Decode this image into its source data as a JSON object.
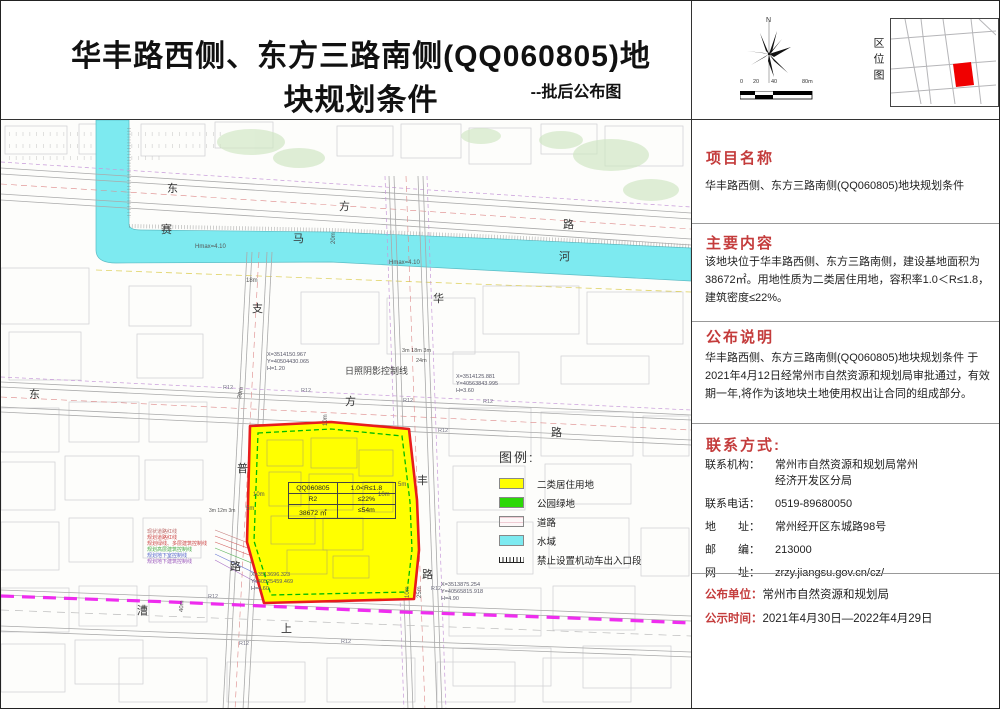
{
  "header": {
    "title": "华丰路西侧、东方三路南侧(QQ060805)地块规划条件",
    "subtitle": "--批后公布图"
  },
  "topright": {
    "north_label": "N",
    "scale_labels": [
      "0",
      "20",
      "40",
      "80m"
    ],
    "location_map_label": "区位图",
    "location_accent": "#f00000"
  },
  "sidebar": {
    "sections": [
      {
        "heading": "项目名称",
        "body": "华丰路西侧、东方三路南侧(QQ060805)地块规划条件"
      },
      {
        "heading": "主要内容",
        "body": "该地块位于华丰路西侧、东方三路南侧，建设基地面积为38672㎡。用地性质为二类居住用地，容积率1.0＜R≤1.8，建筑密度≤22%。"
      },
      {
        "heading": "公布说明",
        "body": "华丰路西侧、东方三路南侧(QQ060805)地块规划条件 于2021年4月12日经常州市自然资源和规划局审批通过，有效期一年,将作为该地块土地使用权出让合同的组成部分。"
      }
    ],
    "contact": {
      "heading": "联系方式:",
      "rows": [
        {
          "label": "联系机构：",
          "value": "常州市自然资源和规划局常州\n经济开发区分局"
        },
        {
          "label": "联系电话：",
          "value": "0519-89680050"
        },
        {
          "label": "地　　址：",
          "value": "常州经开区东城路98号"
        },
        {
          "label": "邮　　编：",
          "value": "213000"
        },
        {
          "label": "网　　址：",
          "value": "zrzy.jiangsu.gov.cn/cz/"
        }
      ]
    },
    "footer": [
      {
        "label": "公布单位：",
        "value": "常州市自然资源和规划局"
      },
      {
        "label": "公示时间：",
        "value": "2021年4月30日—2022年4月29日"
      }
    ]
  },
  "map": {
    "colors": {
      "water": "#7deaf0",
      "parcel_fill": "#ffff00",
      "parcel_border": "#e81c1c",
      "green_control_line": "#00bb00",
      "boundary_magenta": "#ee22ee",
      "heading_red": "#c43c3c"
    },
    "legend": {
      "title": "图例:",
      "items": [
        {
          "type": "residential",
          "label": "二类居住用地",
          "color": "#ffff00"
        },
        {
          "type": "park",
          "label": "公园绿地",
          "color": "#2cd806"
        },
        {
          "type": "road",
          "label": "道路",
          "color": "#fdf7f8"
        },
        {
          "type": "water",
          "label": "水域",
          "color": "#7deaf0"
        },
        {
          "type": "no-vehicle-access",
          "label": "禁止设置机动车出入口段",
          "color": "#222222"
        }
      ]
    },
    "parcel_table": {
      "rows": [
        [
          "QQ060805",
          "1.0<R≤1.8"
        ],
        [
          "R2",
          "≤22%"
        ],
        [
          "38672 ㎡",
          "≤54m"
        ]
      ]
    },
    "labels": [
      {
        "t": "东",
        "x": 166,
        "y": 62
      },
      {
        "t": "方",
        "x": 338,
        "y": 80
      },
      {
        "t": "路",
        "x": 562,
        "y": 98
      },
      {
        "t": "赛",
        "x": 160,
        "y": 103
      },
      {
        "t": "马",
        "x": 292,
        "y": 112
      },
      {
        "t": "河",
        "x": 558,
        "y": 130
      },
      {
        "t": "东",
        "x": 28,
        "y": 268
      },
      {
        "t": "方",
        "x": 344,
        "y": 275
      },
      {
        "t": "路",
        "x": 550,
        "y": 306
      },
      {
        "t": "华",
        "x": 432,
        "y": 172
      },
      {
        "t": "丰",
        "x": 416,
        "y": 354
      },
      {
        "t": "路",
        "x": 421,
        "y": 448
      },
      {
        "t": "支",
        "x": 251,
        "y": 182
      },
      {
        "t": "普",
        "x": 236,
        "y": 342
      },
      {
        "t": "路",
        "x": 229,
        "y": 440
      },
      {
        "t": "漕",
        "x": 136,
        "y": 484
      },
      {
        "t": "上",
        "x": 280,
        "y": 502
      },
      {
        "t": "18m",
        "x": 245,
        "y": 158,
        "s": 6,
        "c": "#555"
      },
      {
        "t": "Hmax=4.10",
        "x": 194,
        "y": 124,
        "s": 6,
        "c": "#555"
      },
      {
        "t": "Hmax=4.10",
        "x": 388,
        "y": 140,
        "s": 6,
        "c": "#555"
      },
      {
        "t": "日照阴影控制线",
        "x": 344,
        "y": 246,
        "s": 9,
        "c": "#444"
      },
      {
        "t": "3m 18m 3m",
        "x": 401,
        "y": 228,
        "s": 5.5,
        "c": "#555"
      },
      {
        "t": "24m",
        "x": 415,
        "y": 238,
        "s": 5.5,
        "c": "#555"
      },
      {
        "t": "3m 12m 3m",
        "x": 208,
        "y": 388,
        "s": 5,
        "c": "#555"
      },
      {
        "t": "10m",
        "x": 252,
        "y": 372,
        "s": 6,
        "c": "#555"
      },
      {
        "t": "5m",
        "x": 245,
        "y": 386,
        "s": 6,
        "c": "#555"
      },
      {
        "t": "10m",
        "x": 377,
        "y": 372,
        "s": 6,
        "c": "#555"
      },
      {
        "t": "5m",
        "x": 397,
        "y": 362,
        "s": 6,
        "c": "#555"
      },
      {
        "t": "R12",
        "x": 222,
        "y": 265,
        "s": 5.5,
        "c": "#778"
      },
      {
        "t": "R12",
        "x": 300,
        "y": 268,
        "s": 5.5,
        "c": "#778"
      },
      {
        "t": "R12",
        "x": 402,
        "y": 278,
        "s": 5.5,
        "c": "#778"
      },
      {
        "t": "R12",
        "x": 482,
        "y": 279,
        "s": 5.5,
        "c": "#778"
      },
      {
        "t": "R12",
        "x": 437,
        "y": 308,
        "s": 5.5,
        "c": "#778"
      },
      {
        "t": "R12",
        "x": 207,
        "y": 474,
        "s": 5.5,
        "c": "#778"
      },
      {
        "t": "R12",
        "x": 238,
        "y": 521,
        "s": 5.5,
        "c": "#778"
      },
      {
        "t": "R12",
        "x": 430,
        "y": 466,
        "s": 5.5,
        "c": "#778"
      },
      {
        "t": "R12",
        "x": 340,
        "y": 519,
        "s": 5.5,
        "c": "#778"
      },
      {
        "t": "X=3514150.967\nY=40504430.065\nH=1.20",
        "x": 266,
        "y": 232,
        "s": 5.5,
        "c": "#556"
      },
      {
        "t": "X=3514125.881\nY=40563843.995\nH=3.60",
        "x": 455,
        "y": 254,
        "s": 5.5,
        "c": "#556"
      },
      {
        "t": "X=3513696.323\nY=40525459.469\nH=4.60",
        "x": 250,
        "y": 452,
        "s": 5.5,
        "c": "#556"
      },
      {
        "t": "X=3513875.254\nY=40565815.918\nH=4.90",
        "x": 440,
        "y": 462,
        "s": 5.5,
        "c": "#556"
      },
      {
        "t": "30m",
        "x": 236,
        "y": 278,
        "s": 6,
        "c": "#555",
        "r": -78
      },
      {
        "t": "40m",
        "x": 178,
        "y": 492,
        "s": 6,
        "c": "#555",
        "r": -88
      },
      {
        "t": "20m",
        "x": 330,
        "y": 124,
        "s": 6,
        "c": "#555",
        "r": -90
      },
      {
        "t": "10m",
        "x": 322,
        "y": 306,
        "s": 6,
        "c": "#555",
        "r": -90
      },
      {
        "t": "10m",
        "x": 404,
        "y": 478,
        "s": 6,
        "c": "#555",
        "r": -90
      },
      {
        "t": "25m",
        "x": 416,
        "y": 478,
        "s": 6,
        "c": "#555",
        "r": -90
      },
      {
        "t": "现状道路红线",
        "x": 146,
        "y": 409,
        "s": 5,
        "c": "#bb6666"
      },
      {
        "t": "规划道路红线",
        "x": 146,
        "y": 415,
        "s": 5,
        "c": "#cc4444"
      },
      {
        "t": "规划绿线、多层建筑控制线",
        "x": 146,
        "y": 421,
        "s": 5,
        "c": "#cc4444"
      },
      {
        "t": "规划高层建筑控制线",
        "x": 146,
        "y": 427,
        "s": 5,
        "c": "#44aa44"
      },
      {
        "t": "规划地下室控制线",
        "x": 146,
        "y": 433,
        "s": 5,
        "c": "#5566cc"
      },
      {
        "t": "规划地下建筑控制线",
        "x": 146,
        "y": 439,
        "s": 5,
        "c": "#9955bb"
      }
    ]
  }
}
